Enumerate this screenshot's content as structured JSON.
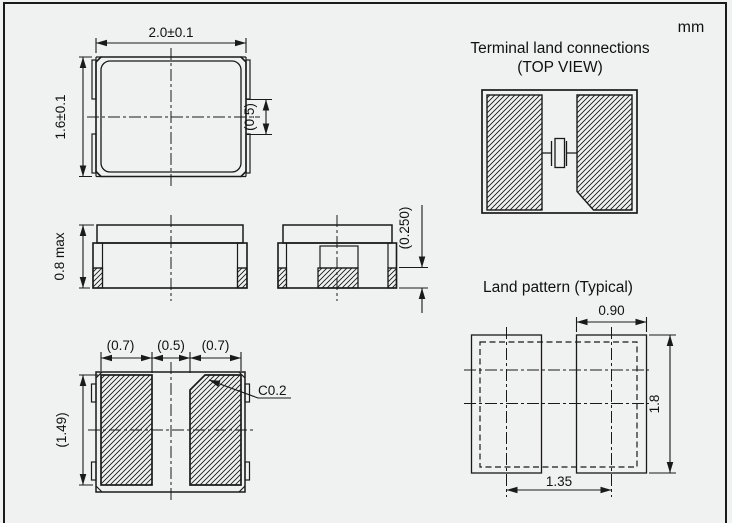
{
  "unit": "mm",
  "colors": {
    "line": "#1a1a1a",
    "background": "#f0f1f1"
  },
  "top_view": {
    "width": "2.0±0.1",
    "height": "1.6±0.1",
    "notch": "(0.5)"
  },
  "front_view": {
    "height": "0.8 max"
  },
  "end_view": {
    "standoff": "(0.250)"
  },
  "bottom_view": {
    "pad_width_left": "(0.7)",
    "gap": "(0.5)",
    "pad_width_right": "(0.7)",
    "pad_height": "(1.49)",
    "chamfer": "C0.2"
  },
  "terminal_land": {
    "title1": "Terminal land connections",
    "title2": "(TOP VIEW)"
  },
  "land_pattern": {
    "title": "Land pattern (Typical)",
    "pad_width": "0.90",
    "pad_height": "1.8",
    "pitch": "1.35"
  }
}
